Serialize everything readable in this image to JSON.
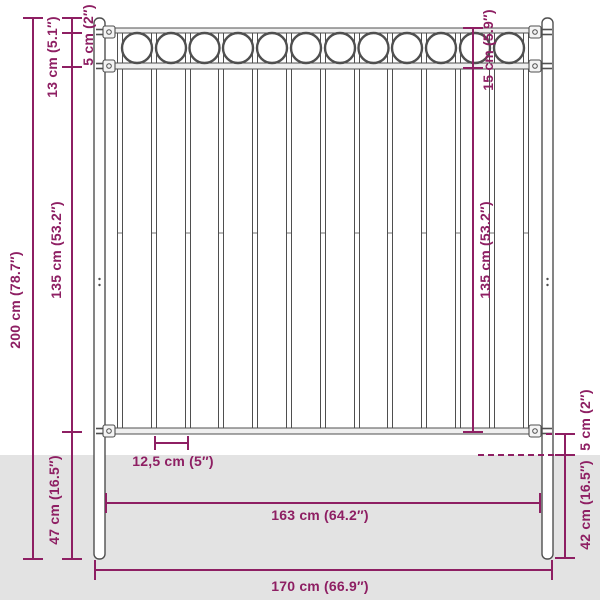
{
  "diagram": {
    "type": "product-dimension-diagram",
    "subject": "metal fence panel with posts and circle-ornament top band",
    "colors": {
      "dimension_accent": "#8e1f63",
      "ground_fill": "#e3e3e3",
      "fence_outline": "#4f4f4f",
      "background": "#ffffff"
    },
    "labels": {
      "height_total": "200 cm (78.7″)",
      "top_ornament_height": "13 cm (5.1″)",
      "post_top_offset": "5 cm (2″)",
      "panel_height_left": "135 cm (53.2″)",
      "post_underground_left": "47 cm (16.5″)",
      "ornament_band_height": "15 cm (5.9″)",
      "panel_height_right": "135 cm (53.2″)",
      "rail_to_ground": "5 cm (2″)",
      "post_underground_right": "42 cm (16.5″)",
      "bar_spacing": "12,5 cm (5″)",
      "panel_width": "163 cm (64.2″)",
      "total_width": "170 cm (66.9″)"
    }
  }
}
